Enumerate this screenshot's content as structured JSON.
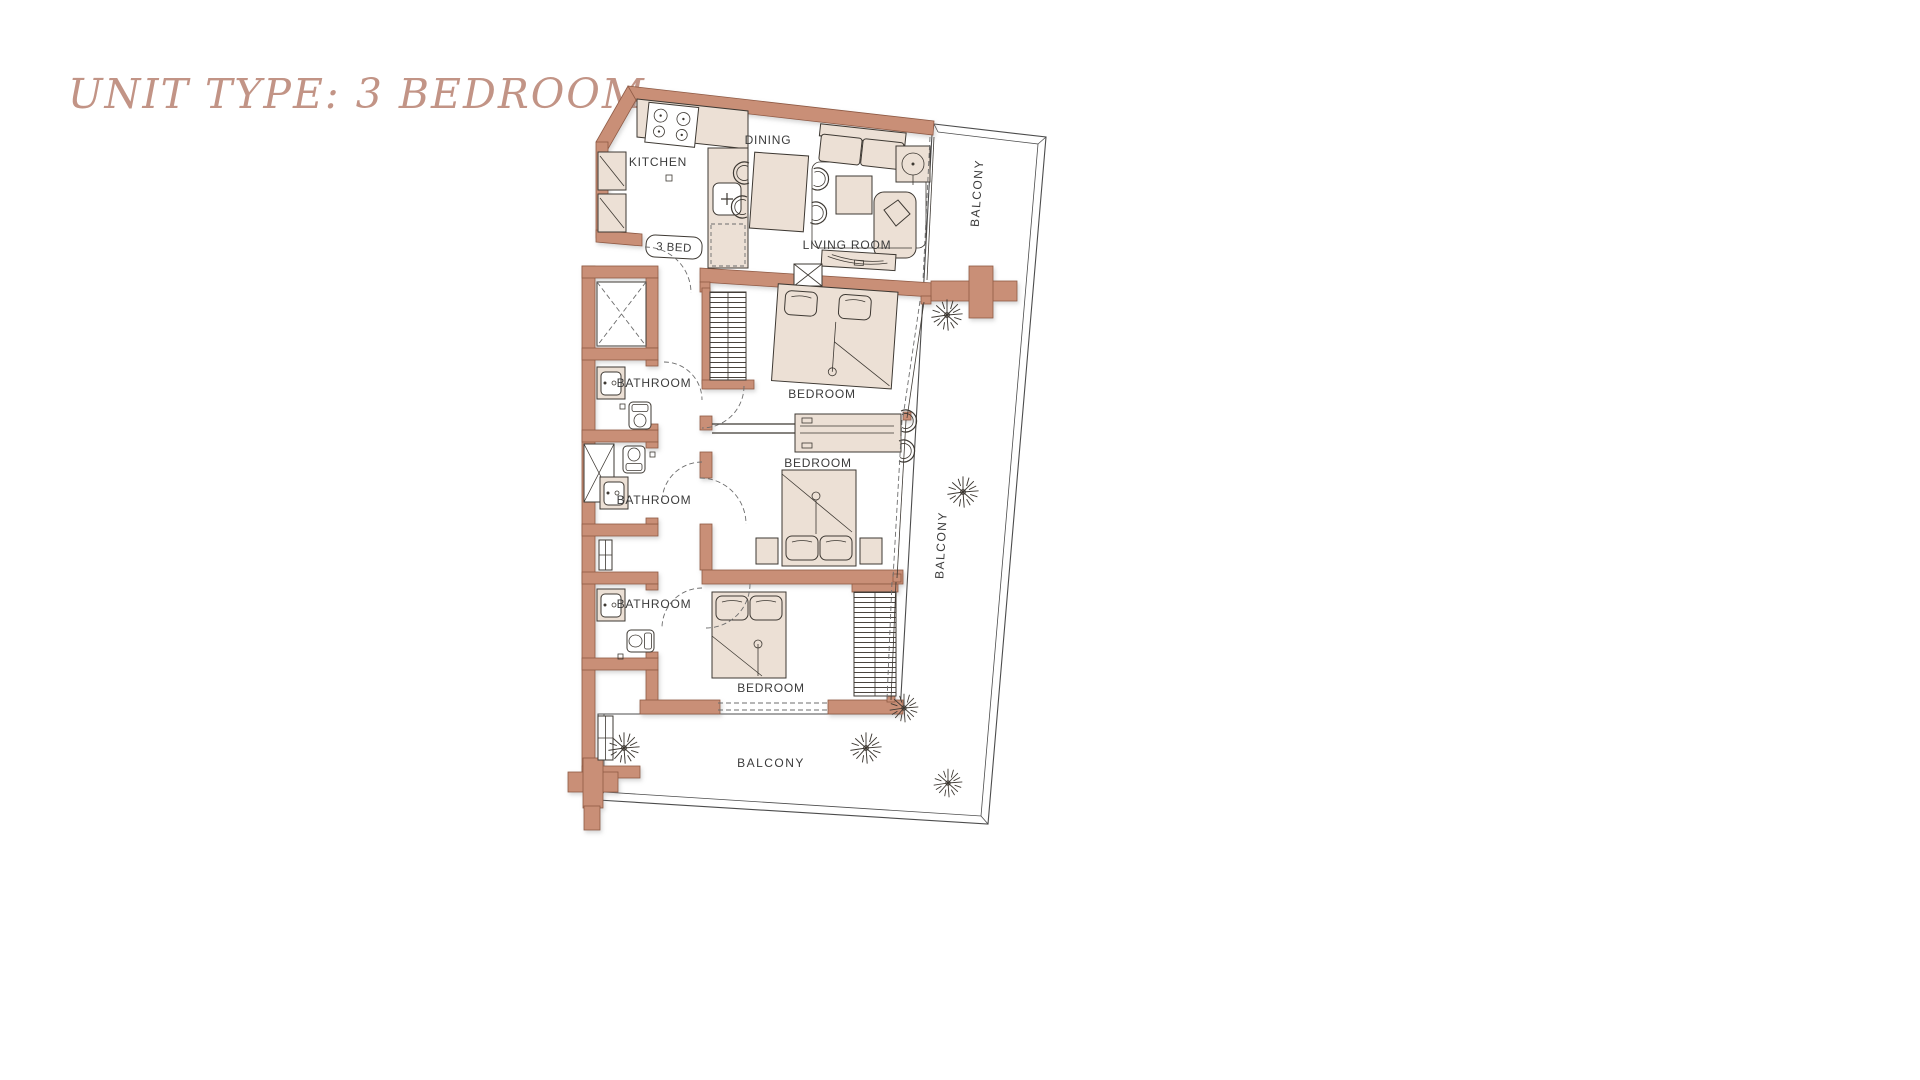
{
  "title": "UNIT TYPE: 3 BEDROOM",
  "badge": "3 BED",
  "labels": {
    "kitchen": "KITCHEN",
    "dining": "DINING",
    "living_room": "LIVING ROOM",
    "bedroom_1": "BEDROOM",
    "bedroom_2": "BEDROOM",
    "bedroom_3": "BEDROOM",
    "bathroom_1": "BATHROOM",
    "bathroom_2": "BATHROOM",
    "bathroom_3": "BATHROOM",
    "balcony_top_right": "BALCONY",
    "balcony_right": "BALCONY",
    "balcony_bottom": "BALCONY"
  },
  "colors": {
    "title": "#c29486",
    "wall": "#c98f77",
    "wall_stroke": "#8f5a44",
    "furniture": "#ece0d5",
    "line": "#3e3933",
    "railing": "#4c4c4c",
    "background": "#ffffff"
  }
}
